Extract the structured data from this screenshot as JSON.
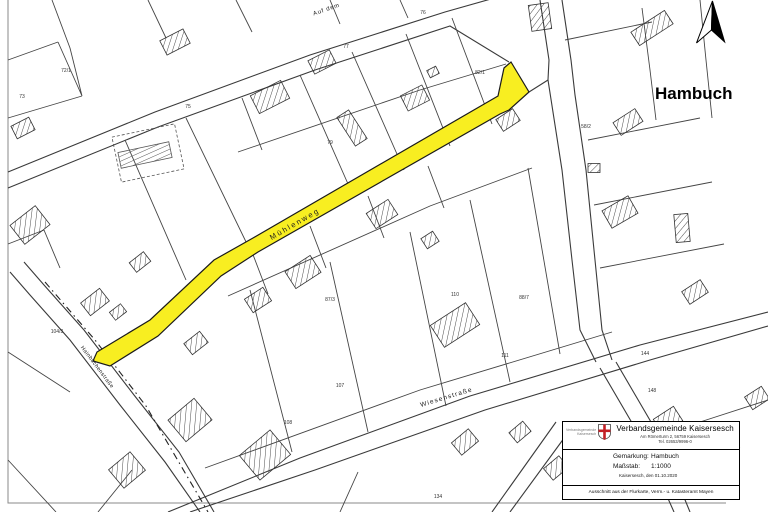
{
  "map": {
    "town_label": "Hambuch",
    "highlighted_street": "Mühlenweg",
    "highlight_color": "#f8ee21",
    "street_labels": [
      {
        "text": "Mühlenweg",
        "x": 296,
        "y": 226,
        "rot": -30,
        "size": 7.5,
        "spacing": 2
      },
      {
        "text": "Wiesenstraße",
        "x": 447,
        "y": 399,
        "rot": -17,
        "size": 6.5,
        "spacing": 1.2
      },
      {
        "text": "Hainbüchenstraße",
        "x": 96,
        "y": 368,
        "rot": 53,
        "size": 5.5,
        "spacing": 0.4
      },
      {
        "text": "Auf dem",
        "x": 327,
        "y": 11,
        "rot": -19,
        "size": 6,
        "spacing": 0.8
      }
    ],
    "parcel_numbers": [
      {
        "text": "76",
        "x": 423,
        "y": 14
      },
      {
        "text": "77",
        "x": 346,
        "y": 48
      },
      {
        "text": "75",
        "x": 188,
        "y": 108
      },
      {
        "text": "72/1",
        "x": 66,
        "y": 72
      },
      {
        "text": "73",
        "x": 22,
        "y": 98
      },
      {
        "text": "79",
        "x": 330,
        "y": 144
      },
      {
        "text": "82/1",
        "x": 480,
        "y": 74
      },
      {
        "text": "58/2",
        "x": 586,
        "y": 128
      },
      {
        "text": "87/3",
        "x": 330,
        "y": 301
      },
      {
        "text": "88/7",
        "x": 524,
        "y": 299
      },
      {
        "text": "110",
        "x": 455,
        "y": 296
      },
      {
        "text": "111",
        "x": 505,
        "y": 357
      },
      {
        "text": "108",
        "x": 288,
        "y": 424
      },
      {
        "text": "107",
        "x": 340,
        "y": 387
      },
      {
        "text": "144",
        "x": 645,
        "y": 355
      },
      {
        "text": "148",
        "x": 652,
        "y": 392
      },
      {
        "text": "104/3",
        "x": 57,
        "y": 333
      },
      {
        "text": "134",
        "x": 438,
        "y": 498
      }
    ]
  },
  "info_box": {
    "logo_caption_line1": "Verbandsgemeinde",
    "logo_caption_line2": "Kaisersesch",
    "title": "Verbandsgemeinde Kaisersesch",
    "address": "Am Römerturm 2, 56759 Kaisersesch",
    "phone": "Tel. 02653/9996-0",
    "fields": [
      {
        "label": "Gemarkung:",
        "value": "Hambuch"
      },
      {
        "label": "Maßstab:",
        "value": "1:1000"
      }
    ],
    "date_line": "Kaisersesch, den 01.10.2020",
    "footer": "Ausschnitt aus der Flurkarte, Verm.- u. Katasteramt Mayen"
  }
}
